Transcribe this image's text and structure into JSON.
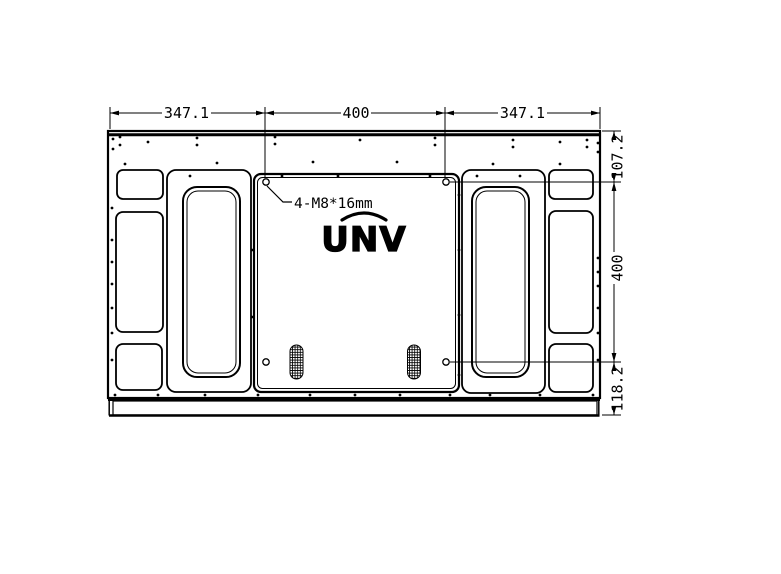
{
  "dimensions": {
    "top": [
      "347.1",
      "400",
      "347.1"
    ],
    "right": [
      "107.2",
      "400",
      "118.2"
    ]
  },
  "annotations": {
    "mount_spec": "4-M8*16mm"
  },
  "logo": {
    "text": "UNV"
  },
  "colors": {
    "line": "#000000",
    "background": "#ffffff"
  }
}
